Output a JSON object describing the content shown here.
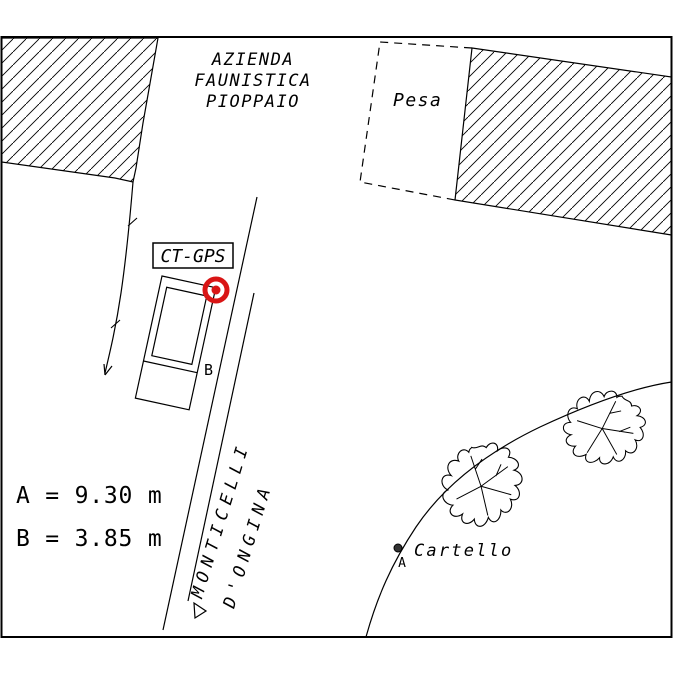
{
  "drawing": {
    "title_area": {
      "line1": "AZIENDA",
      "line2": "FAUNISTICA",
      "line3": "PIOPPAIO"
    },
    "pesa_label": "Pesa",
    "station_label": "CT-GPS",
    "road_name": {
      "line1": "MONTICELLI",
      "line2": "D'ONGINA"
    },
    "measurements": {
      "a": "A = 9.30 m",
      "b": "B = 3.85 m"
    },
    "cartello_label": "Cartello",
    "point_a_label": "A",
    "point_b_label": "B",
    "colors": {
      "target_red": "#d91515",
      "line_black": "#000000",
      "background": "#ffffff"
    }
  }
}
